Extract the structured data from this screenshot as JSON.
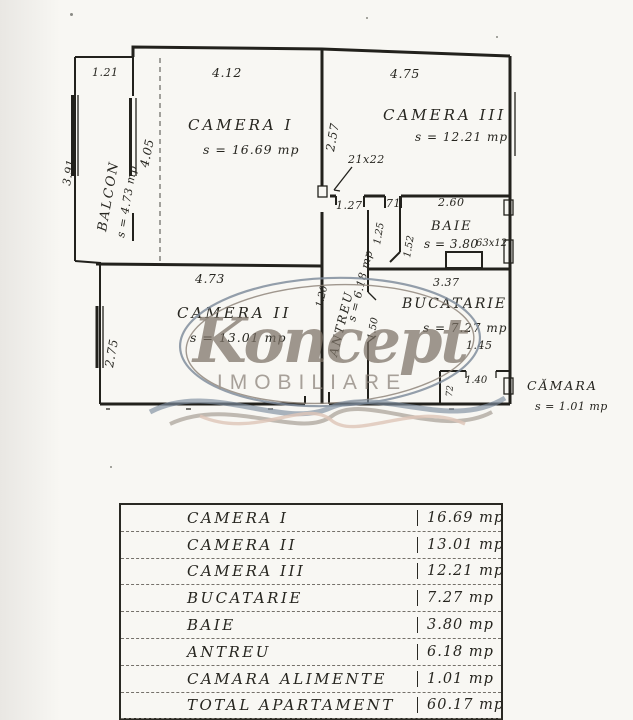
{
  "watermark": {
    "brand": "Koncept",
    "subtitle": "IMOBILIARE"
  },
  "plan": {
    "rooms": {
      "balcon": {
        "label": "BALCON",
        "area": "s = 4.73 mp"
      },
      "camera1": {
        "label": "CAMERA I",
        "area": "s = 16.69 mp"
      },
      "camera2": {
        "label": "CAMERA II",
        "area": "s = 13.01 mp"
      },
      "camera3": {
        "label": "CAMERA III",
        "area": "s = 12.21 mp"
      },
      "baie": {
        "label": "BAIE",
        "area": "s = 3.80",
        "note": "63x12"
      },
      "bucatarie": {
        "label": "BUCATARIE",
        "area": "s = 7.27 mp"
      },
      "antreu": {
        "label": "ANTREU",
        "area": "s = 6.18 mp"
      },
      "camara": {
        "label": "CĂMARA",
        "area": "s = 1.01 mp"
      }
    },
    "dims": {
      "balcon_top": "1.21",
      "camera1_top": "4.12",
      "camera3_top": "4.75",
      "balcon_left": "3.91",
      "balcon_door": "4.05",
      "camera3_left": "2.57",
      "window_note": "21x22",
      "hall_a": "1.27",
      "hall_b": "71",
      "baie_top": "2.60",
      "baie_left": "1.25",
      "baie_wall": "1.52",
      "bucatarie_top": "3.37",
      "antreu_left": "1.20",
      "antreu_right": "1.50",
      "camera2_top": "4.73",
      "camera2_left": "2.75",
      "bucatarie_inner": "1.45",
      "camara_top": "1.40",
      "camara_side": "72"
    }
  },
  "table": {
    "rows": [
      {
        "label": "CAMERA I",
        "value": "16.69 mp"
      },
      {
        "label": "CAMERA II",
        "value": "13.01 mp"
      },
      {
        "label": "CAMERA III",
        "value": "12.21 mp"
      },
      {
        "label": "BUCATARIE",
        "value": "7.27 mp"
      },
      {
        "label": "BAIE",
        "value": "3.80 mp"
      },
      {
        "label": "ANTREU",
        "value": "6.18 mp"
      },
      {
        "label": "CAMARA ALIMENTE",
        "value": "1.01 mp"
      },
      {
        "label": "TOTAL APARTAMENT",
        "value": "60.17 mp"
      },
      {
        "label": "",
        "value": "4.73"
      }
    ]
  }
}
